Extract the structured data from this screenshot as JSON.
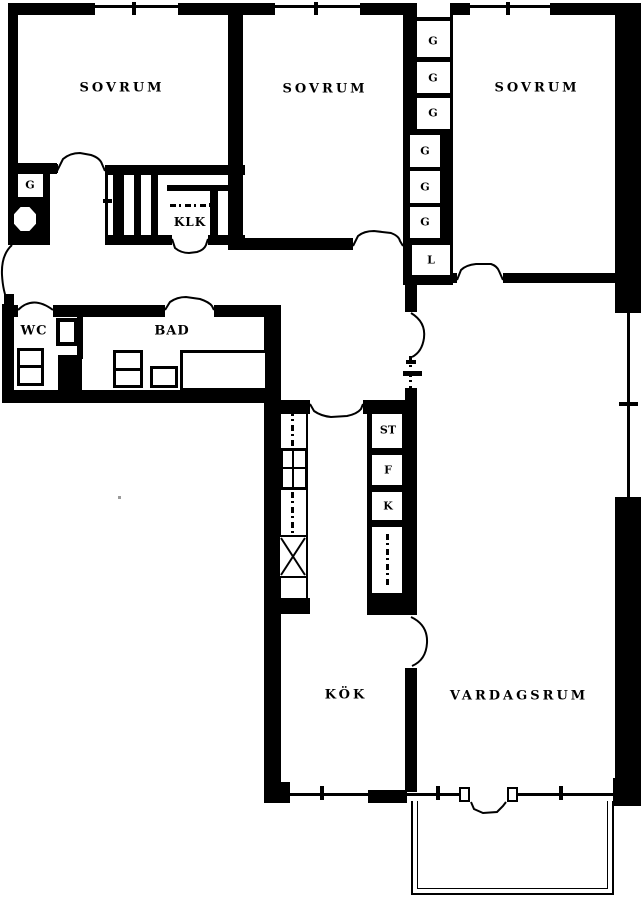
{
  "labels": {
    "bedroom1": "SOVRUM",
    "bedroom2": "SOVRUM",
    "bedroom3": "SOVRUM",
    "kitchen": "KÖK",
    "living_room": "VARDAGSRUM",
    "bathroom": "BAD",
    "wc": "WC",
    "walk_in_closet": "KLK",
    "hall_wardrobe": "G"
  },
  "wardrobe_column": {
    "slots": [
      "G",
      "G",
      "G",
      "G",
      "G",
      "G",
      "L"
    ]
  },
  "kitchen_units": {
    "cleaning_closet": "ST",
    "freezer": "F",
    "fridge": "K"
  },
  "colors": {
    "ink": "#000000",
    "paper": "#ffffff"
  }
}
